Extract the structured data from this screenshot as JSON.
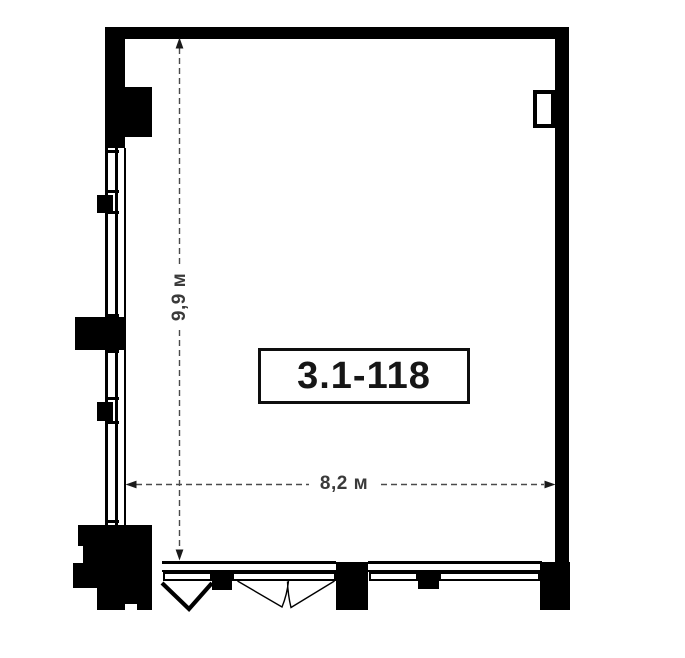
{
  "plan": {
    "unit_label": "3.1-118",
    "dimensions": {
      "vertical": "9,9 м",
      "horizontal": "8,2 м"
    }
  },
  "colors": {
    "wall": "#000000",
    "background": "#ffffff",
    "dimension_text": "#3a3a3a",
    "dimension_line": "#4a4a4a",
    "unit_text": "#161616",
    "unit_box_border": "#0e0e0e"
  }
}
